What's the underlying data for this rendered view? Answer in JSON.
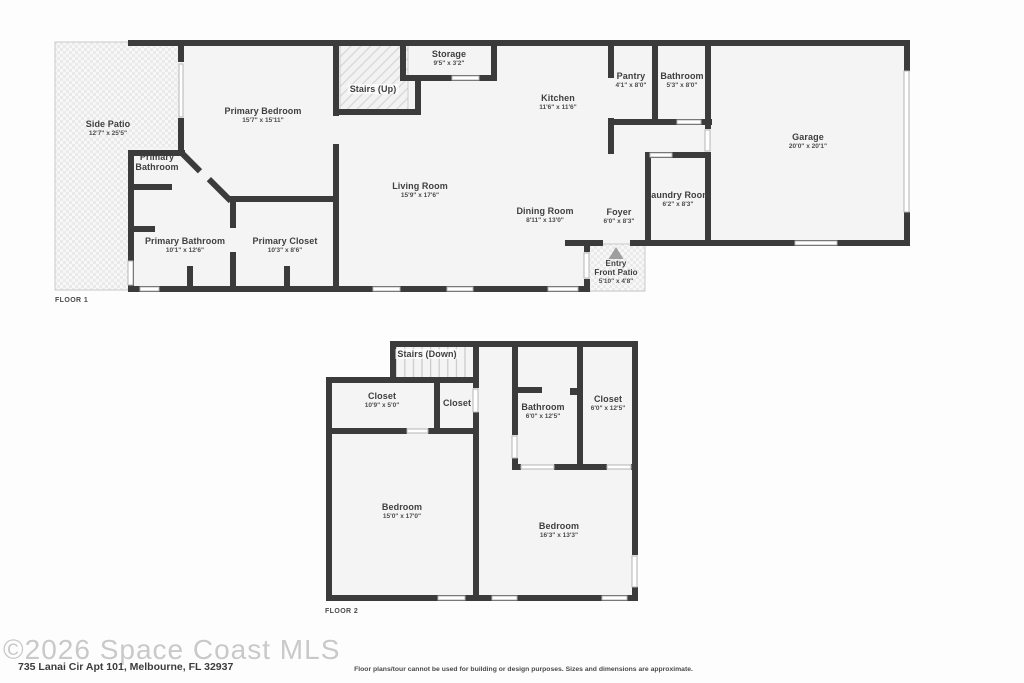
{
  "watermark": "©2026 Space Coast MLS",
  "address": "735 Lanai Cir Apt 101, Melbourne, FL 32937",
  "disclaimer": "Floor plans/tour cannot be used for building or design purposes. Sizes and dimensions are approximate.",
  "colors": {
    "wall": "#3b3b3b",
    "room_fill": "#f4f4f4",
    "label_text": "#3f3f3f",
    "watermark_text": "#c9c9c9"
  },
  "floor1": {
    "label": "FLOOR 1",
    "rooms": [
      {
        "name": "Side Patio",
        "dims": "12'7\" x 25'5\""
      },
      {
        "name": "Primary Bedroom",
        "dims": "15'7\" x 15'11\""
      },
      {
        "name": "Primary Bathroom",
        "dims": ""
      },
      {
        "name": "Stairs (Up)",
        "dims": ""
      },
      {
        "name": "Storage",
        "dims": "9'5\" x 3'2\""
      },
      {
        "name": "Kitchen",
        "dims": "11'6\" x 11'6\""
      },
      {
        "name": "Pantry",
        "dims": "4'1\" x 8'0\""
      },
      {
        "name": "Bathroom",
        "dims": "5'3\" x 8'0\""
      },
      {
        "name": "Garage",
        "dims": "20'0\" x 20'1\""
      },
      {
        "name": "Laundry Room",
        "dims": "6'2\" x 8'3\""
      },
      {
        "name": "Foyer",
        "dims": "6'0\" x 8'3\""
      },
      {
        "name": "Dining Room",
        "dims": "8'11\" x 13'0\""
      },
      {
        "name": "Living Room",
        "dims": "15'9\" x 17'6\""
      },
      {
        "name": "Primary Bathroom",
        "dims": "10'1\" x 12'6\""
      },
      {
        "name": "Primary Closet",
        "dims": "10'3\" x 8'6\""
      },
      {
        "name": "Entry",
        "name2": "Front Patio",
        "dims": "5'10\" x 4'8\""
      }
    ]
  },
  "floor2": {
    "label": "FLOOR 2",
    "rooms": [
      {
        "name": "Stairs (Down)",
        "dims": ""
      },
      {
        "name": "Closet",
        "dims": "10'9\" x 5'0\""
      },
      {
        "name": "Closet",
        "dims": ""
      },
      {
        "name": "Bathroom",
        "dims": "6'0\" x 12'5\""
      },
      {
        "name": "Closet",
        "dims": "6'0\" x 12'5\""
      },
      {
        "name": "Bedroom",
        "dims": "15'0\" x 17'0\""
      },
      {
        "name": "Bedroom",
        "dims": "16'3\" x 13'3\""
      }
    ]
  }
}
